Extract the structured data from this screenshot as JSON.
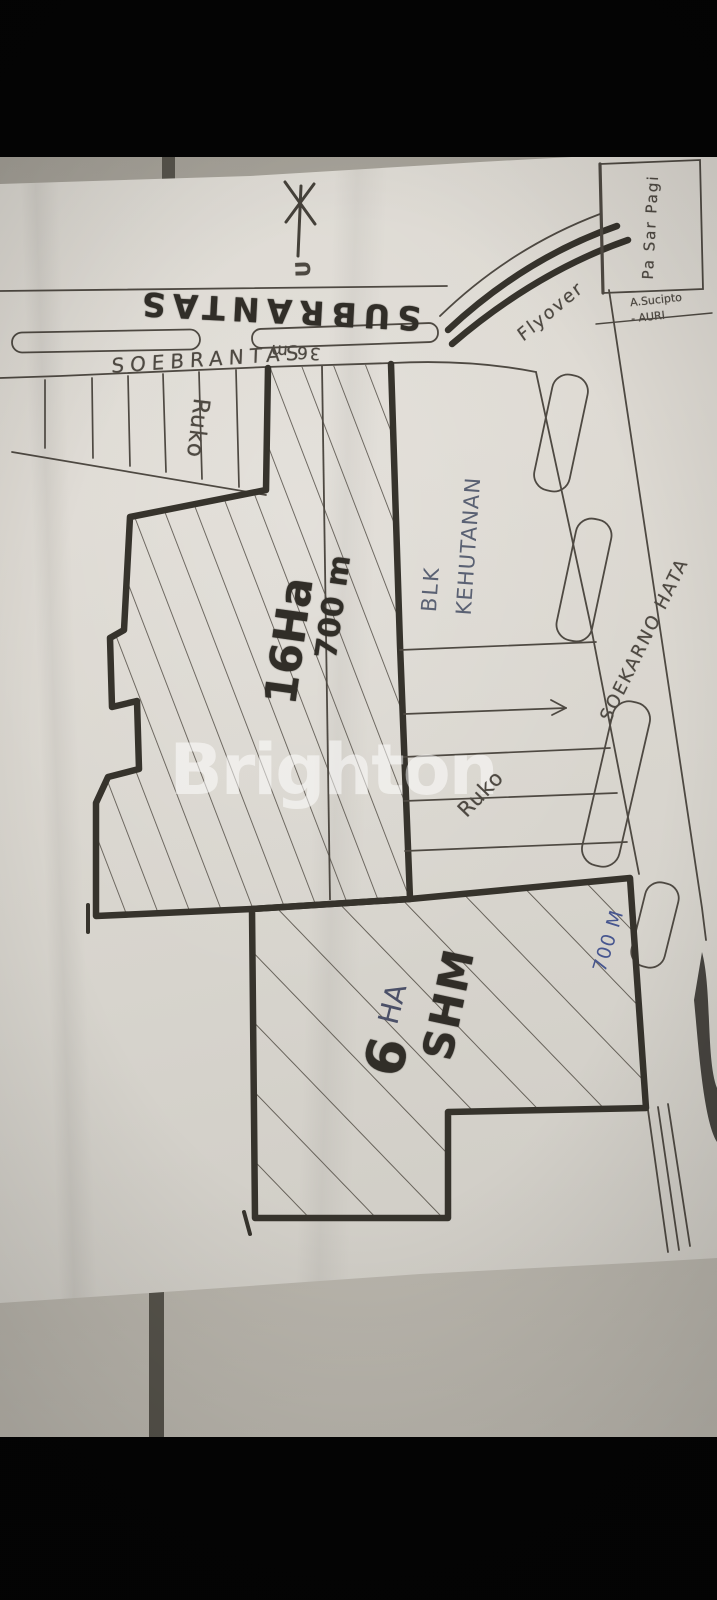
{
  "watermark": {
    "brand": "Brighton"
  },
  "compass": {
    "north_label": "U"
  },
  "roads": {
    "soebrantas_marker_label": "SUBRANTAS",
    "soebrantas_pen_label": "SOEBRANTAS",
    "road_width_note": "36 m",
    "flyover_label": "Flyover",
    "soekarno_hatta_label": "SOEKARNO HATA",
    "frontage_distance": "700 M"
  },
  "landmarks": {
    "market_label": "Pa Sar Pagi",
    "corner_note_line1": "A.Sucipto",
    "corner_note_line2": "- AURI",
    "forestry_block_line1": "BLK",
    "forestry_block_line2": "KEHUTANAN",
    "shophouses_top_label": "Ruko",
    "shophouses_side_label": "Ruko"
  },
  "plots": {
    "main_plot_area": "16Ha",
    "main_plot_depth": "700 m",
    "second_plot_size_number": "6",
    "second_plot_size_unit": "HA",
    "second_plot_certificate": "SHM"
  },
  "colors": {
    "paper": "#d9d6cf",
    "pen_ink": "#4e4942",
    "marker_ink": "#33302a",
    "blue_ink": "#47568f",
    "watermark_white": "#ffffff"
  }
}
